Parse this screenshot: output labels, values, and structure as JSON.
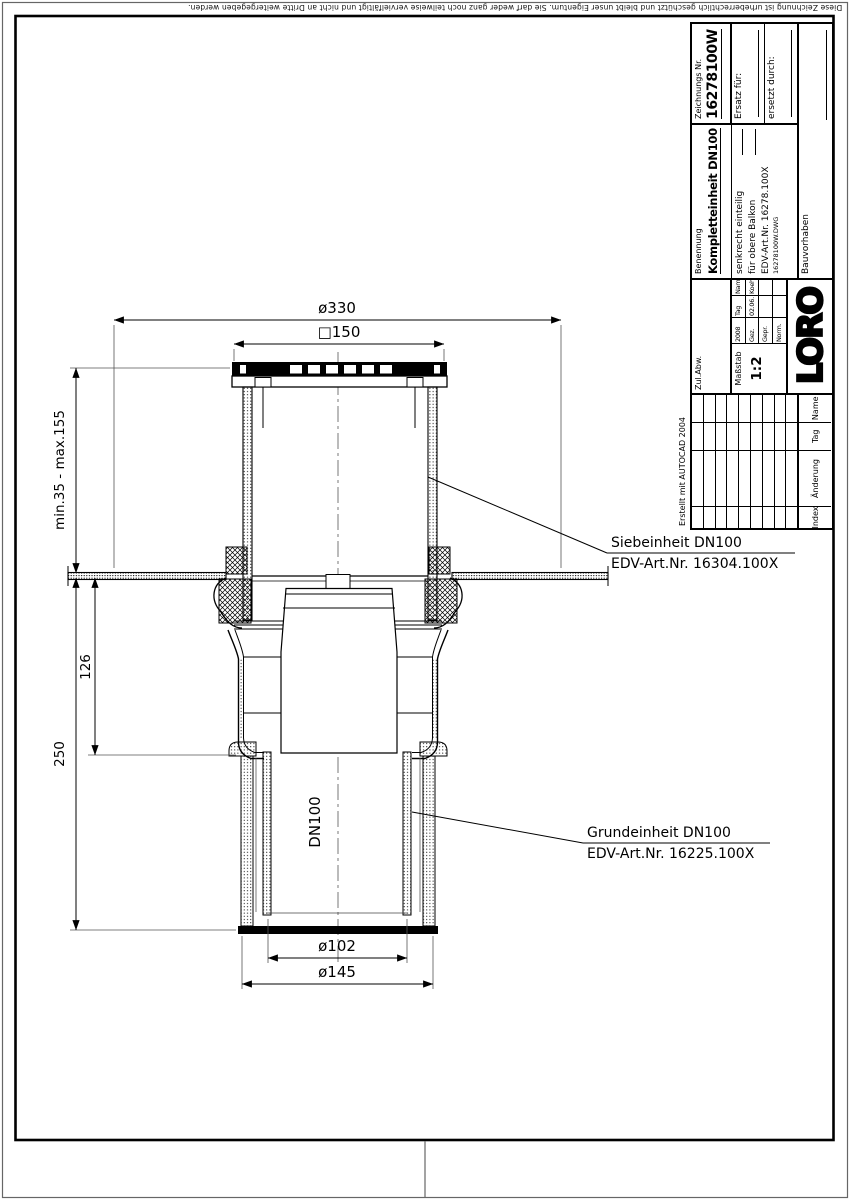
{
  "sheet": {
    "copyright": "Diese Zeichnung ist urheberrechtlich geschützt und bleibt unser Eigentum. Sie darf weder ganz noch teilweise vervielfältigt und nicht an Dritte weitergegeben werden."
  },
  "drawing": {
    "dim_top_width": "ø330",
    "dim_grate": "□150",
    "dim_height_range": "min.35 - max.155",
    "dim_depth_mid": "126",
    "dim_depth_total": "250",
    "pipe_size": "DN100",
    "dim_outlet_inner": "ø102",
    "dim_outlet_outer": "ø145",
    "label_sieb_line1": "Siebeinheit DN100",
    "label_sieb_line2": "EDV-Art.Nr. 16304.100X",
    "label_grund_line1": "Grundeinheit DN100",
    "label_grund_line2": "EDV-Art.Nr. 16225.100X"
  },
  "title_block": {
    "created_with": "Erstellt mit AUTOCAD 2004",
    "tolerance_label": "Zul.Abw.",
    "scale_label": "Maßstab",
    "scale_value": "1:2",
    "year": "2008",
    "col_tag": "Tag",
    "col_name": "Name",
    "row_drawn_label": "Gez.",
    "row_drawn_tag": "02.06.",
    "row_drawn_name": "Koeh",
    "row_checked_label": "Gepr.",
    "row_norm_label": "Norm.",
    "logo": "LORO",
    "name_label": "Benennung",
    "name_value": "Kompletteinheit DN100",
    "desc_line1": "senkrecht einteilig",
    "desc_line2": "für obere Balkon",
    "desc_line3": "EDV-Art.Nr. 16278.100X",
    "desc_line4": "16278100W.DWG",
    "project_label": "Bauvorhaben",
    "drawing_no_label": "Zeichnungs Nr.",
    "drawing_no_value": "16278100W",
    "replacement_for_label": "Ersatz für:",
    "replaced_by_label": "ersetzt durch:",
    "index_header": [
      "Index",
      "Änderung",
      "Tag",
      "Name"
    ]
  }
}
